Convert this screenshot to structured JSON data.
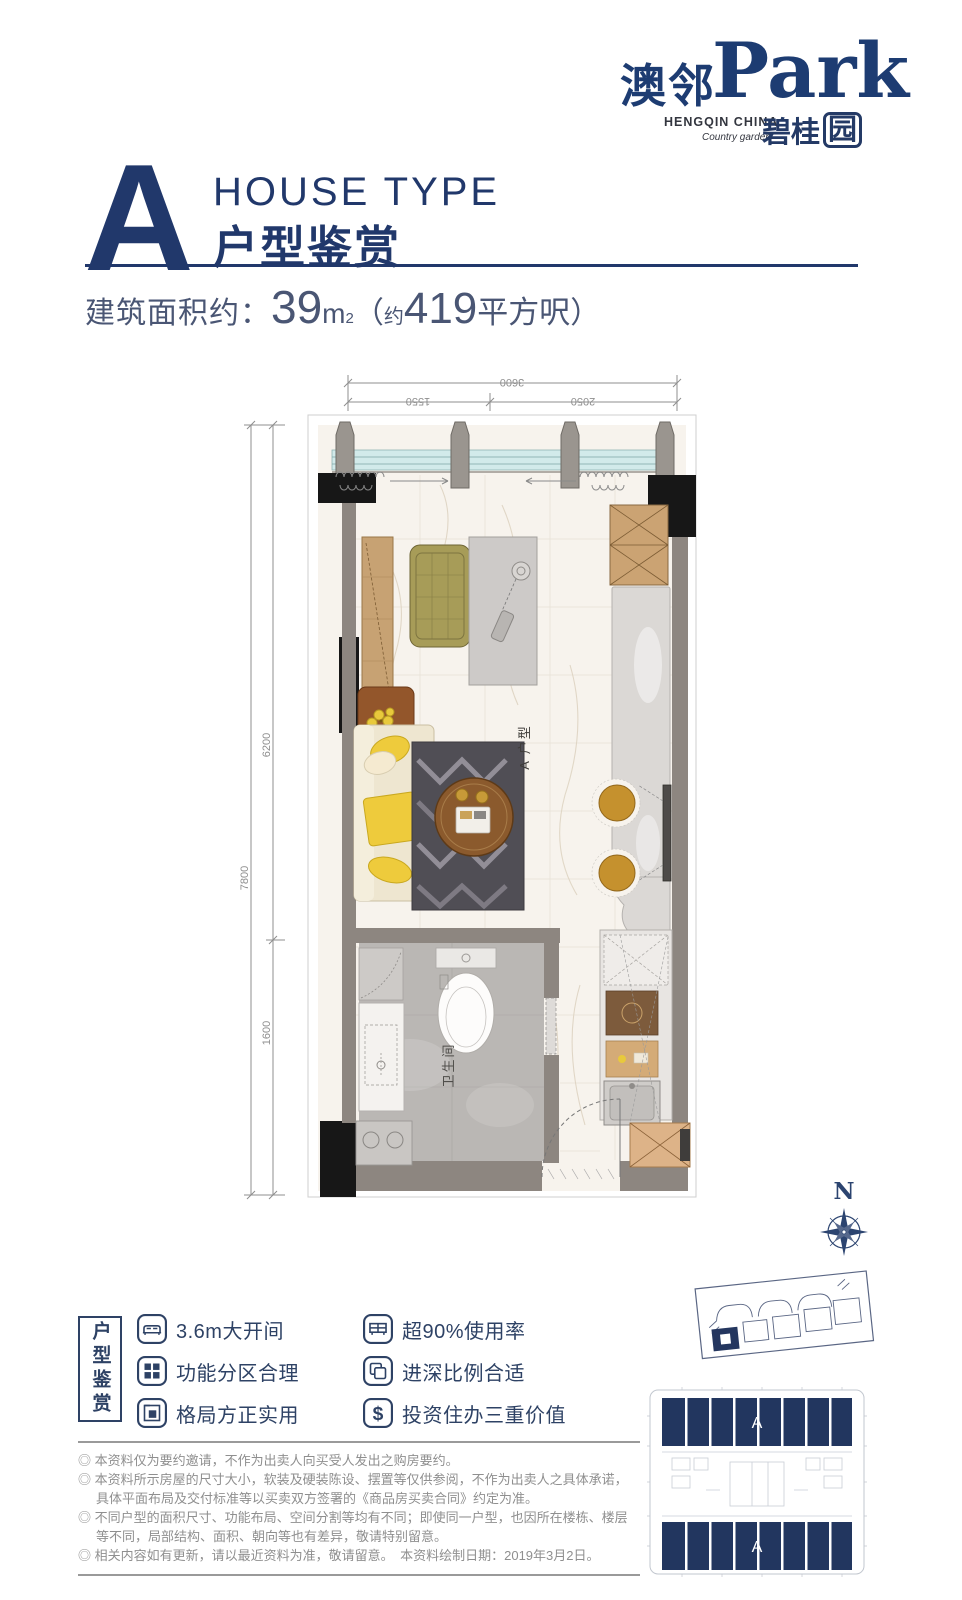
{
  "logo": {
    "cn": "澳邻",
    "en": "Park",
    "sub_en": "HENGQIN CHINA",
    "sub_script": "Country garden",
    "sub_cn_prefix": "碧桂",
    "sub_cn_boxed": "园"
  },
  "header": {
    "letter": "A",
    "title_en": "HOUSE TYPE",
    "title_cn": "户型鉴赏"
  },
  "area": {
    "label": "建筑面积约：",
    "value": "39",
    "unit_base": "m",
    "unit_sup": "2",
    "paren_open": "（",
    "approx": "约",
    "alt_value": "419",
    "alt_unit": "平方呎",
    "paren_close": "）"
  },
  "plan": {
    "unit_label": "A 户型",
    "bathroom_label": "卫生间",
    "dims": {
      "top_total": "3600",
      "top_seg_left": "1550",
      "top_seg_right": "2050",
      "left_total": "7800",
      "left_seg_top": "6200",
      "left_seg_bottom": "1600"
    }
  },
  "compass": {
    "north": "N"
  },
  "features": {
    "section_title": "户型鉴赏",
    "dollar_glyph": "$",
    "items": [
      {
        "icon": "bed-icon",
        "label": "3.6m大开间"
      },
      {
        "icon": "grid-icon",
        "label": "功能分区合理"
      },
      {
        "icon": "layout-icon",
        "label": "格局方正实用"
      },
      {
        "icon": "usage-icon",
        "label": "超90%使用率"
      },
      {
        "icon": "depth-icon",
        "label": "进深比例合适"
      },
      {
        "icon": "value-icon",
        "label": "投资住办三重价值"
      }
    ]
  },
  "keyplan": {
    "unit_top": "A",
    "unit_bottom": "A"
  },
  "disclaimer": {
    "lines": [
      "◎ 本资料仅为要约邀请，不作为出卖人向买受人发出之购房要约。",
      "◎ 本资料所示房屋的尺寸大小，软装及硬装陈设、摆置等仅供参阅，不作为出卖人之具体承诺，具体平面布局及交付标准等以买卖双方签署的《商品房买卖合同》约定为准。",
      "◎ 不同户型的面积尺寸、功能布局、空间分割等均有不同；即使同一户型，也因所在楼栋、楼层等不同，局部结构、面积、朝向等也有差异，敬请特别留意。",
      "◎ 相关内容如有更新，请以最近资料为准，敬请留意。　本资料绘制日期：2019年3月2日。"
    ]
  },
  "colors": {
    "brand_navy": "#21386b",
    "feature_navy": "#2e4265",
    "plate_navy": "#22365f",
    "dim_gray": "#8f8f8f"
  }
}
